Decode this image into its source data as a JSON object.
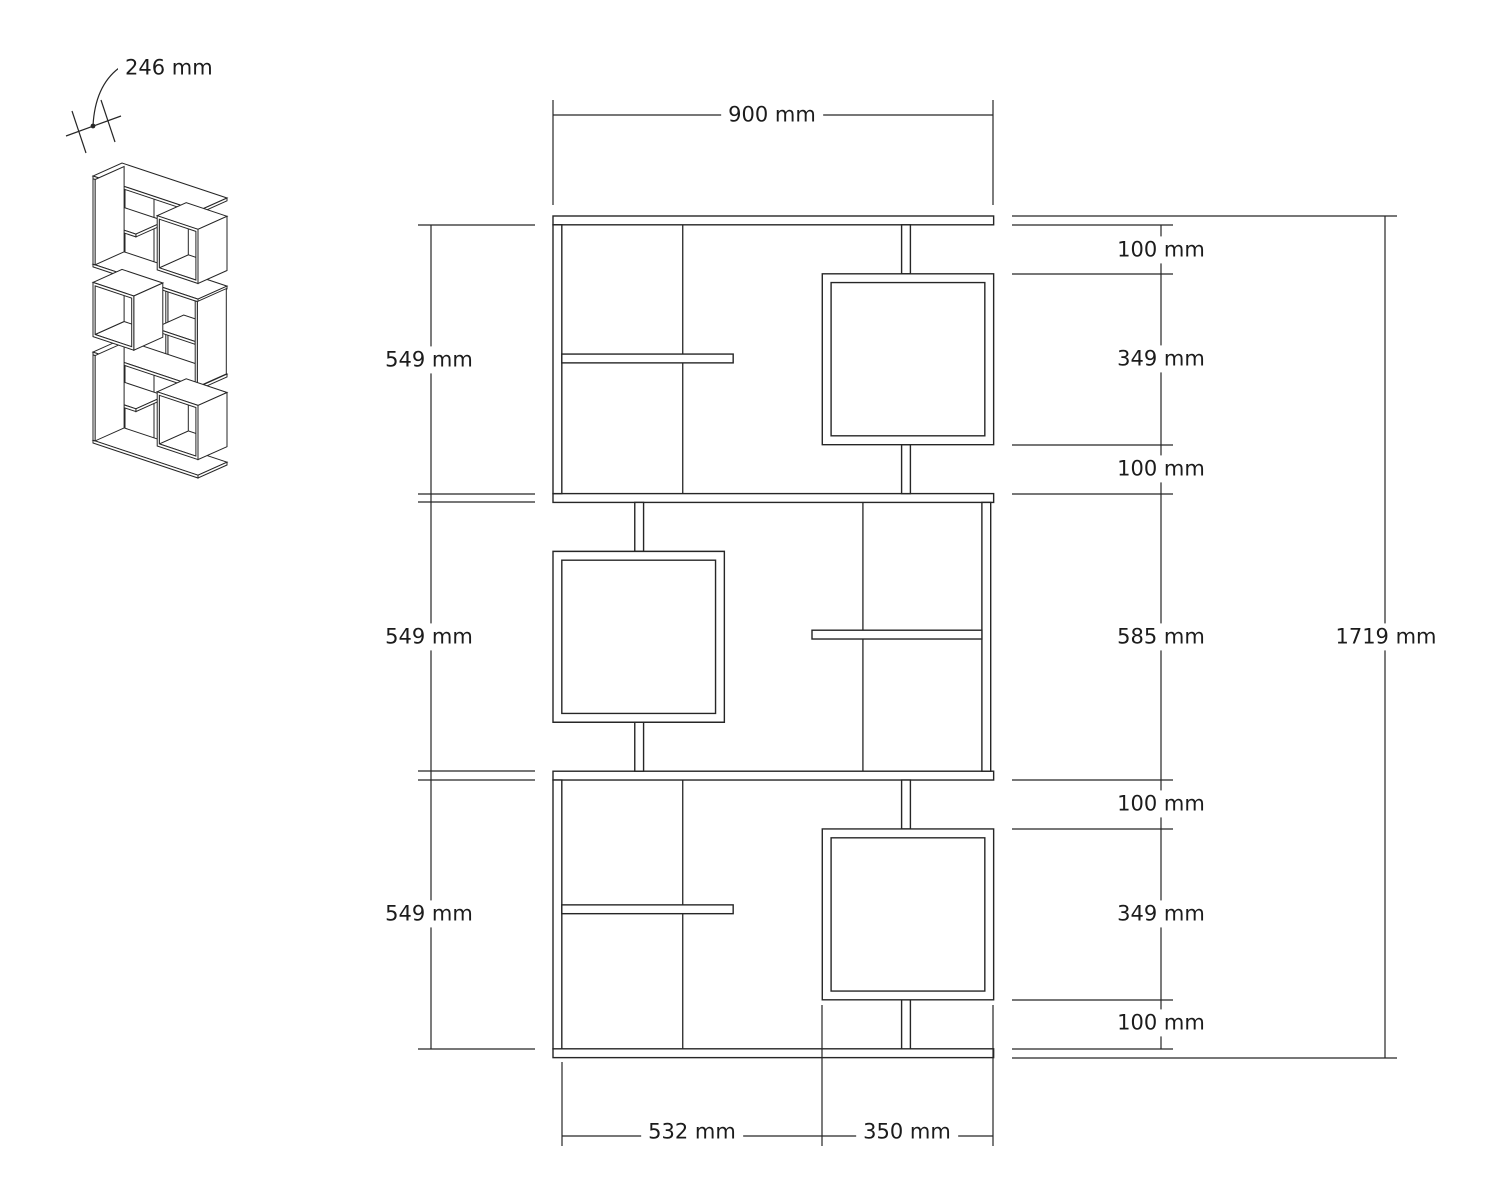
{
  "page": {
    "background": "#ffffff",
    "line_color": "#262626"
  },
  "drawing": {
    "units": "mm",
    "view_types": [
      "isometric-thumbnail",
      "front-elevation"
    ],
    "overall": {
      "width_mm": 900,
      "height_mm": 1719,
      "depth_mm": 246
    },
    "boards": [
      {
        "name": "top-panel",
        "kind": "slab",
        "x": 0,
        "y": 0,
        "w": 900,
        "h": 18
      },
      {
        "name": "mid-panel-upper",
        "kind": "slab",
        "x": 0,
        "y": 567,
        "w": 900,
        "h": 18
      },
      {
        "name": "mid-panel-lower",
        "kind": "slab",
        "x": 0,
        "y": 1134,
        "w": 900,
        "h": 18
      },
      {
        "name": "bottom-panel",
        "kind": "slab",
        "x": 0,
        "y": 1701,
        "w": 900,
        "h": 18
      },
      {
        "name": "side-wall-top-left",
        "kind": "wall",
        "x": 0,
        "y": 18,
        "w": 18,
        "h": 549
      },
      {
        "name": "side-wall-bottom-left",
        "kind": "wall",
        "x": 0,
        "y": 1152,
        "w": 18,
        "h": 549
      },
      {
        "name": "side-wall-middle-right",
        "kind": "wall",
        "x": 876,
        "y": 585,
        "w": 18,
        "h": 549
      },
      {
        "name": "divider-top",
        "kind": "divider",
        "x": 256,
        "y": 18,
        "w": 18,
        "h": 549
      },
      {
        "name": "divider-middle",
        "kind": "divider",
        "x": 624,
        "y": 585,
        "w": 18,
        "h": 549
      },
      {
        "name": "divider-bottom",
        "kind": "divider",
        "x": 256,
        "y": 1152,
        "w": 18,
        "h": 549
      },
      {
        "name": "shelf-top",
        "kind": "slab",
        "x": 18,
        "y": 282,
        "w": 350,
        "h": 18
      },
      {
        "name": "shelf-middle",
        "kind": "slab",
        "x": 529,
        "y": 846,
        "w": 347,
        "h": 18
      },
      {
        "name": "shelf-bottom",
        "kind": "slab",
        "x": 18,
        "y": 1407,
        "w": 350,
        "h": 18
      },
      {
        "name": "post-top-upper",
        "kind": "post",
        "x": 712,
        "y": 18,
        "w": 18,
        "h": 100
      },
      {
        "name": "post-top-lower",
        "kind": "post",
        "x": 712,
        "y": 467,
        "w": 18,
        "h": 100
      },
      {
        "name": "post-middle-upper",
        "kind": "post",
        "x": 167,
        "y": 585,
        "w": 18,
        "h": 100
      },
      {
        "name": "post-middle-lower",
        "kind": "post",
        "x": 167,
        "y": 1034,
        "w": 18,
        "h": 100
      },
      {
        "name": "post-bottom-upper",
        "kind": "post",
        "x": 712,
        "y": 1152,
        "w": 18,
        "h": 100
      },
      {
        "name": "post-bottom-lower",
        "kind": "post",
        "x": 712,
        "y": 1601,
        "w": 18,
        "h": 100
      }
    ],
    "frames": [
      {
        "name": "cube-top-right",
        "x": 550,
        "y": 118,
        "w": 350,
        "h": 349,
        "t": 18
      },
      {
        "name": "cube-middle-left",
        "x": 0,
        "y": 685,
        "w": 350,
        "h": 349,
        "t": 18
      },
      {
        "name": "cube-bottom-right",
        "x": 550,
        "y": 1252,
        "w": 350,
        "h": 349,
        "t": 18
      }
    ]
  },
  "dimensions": {
    "depth": {
      "text": "246 mm"
    },
    "top": {
      "text": "900 mm"
    },
    "left": [
      {
        "text": "549 mm"
      },
      {
        "text": "549 mm"
      },
      {
        "text": "549 mm"
      }
    ],
    "right": [
      {
        "text": "100 mm"
      },
      {
        "text": "349 mm"
      },
      {
        "text": "100 mm"
      },
      {
        "text": "585 mm"
      },
      {
        "text": "100 mm"
      },
      {
        "text": "349 mm"
      },
      {
        "text": "100 mm"
      }
    ],
    "overall_height": {
      "text": "1719 mm"
    },
    "bottom": [
      {
        "text": "532 mm"
      },
      {
        "text": "350 mm"
      }
    ]
  }
}
